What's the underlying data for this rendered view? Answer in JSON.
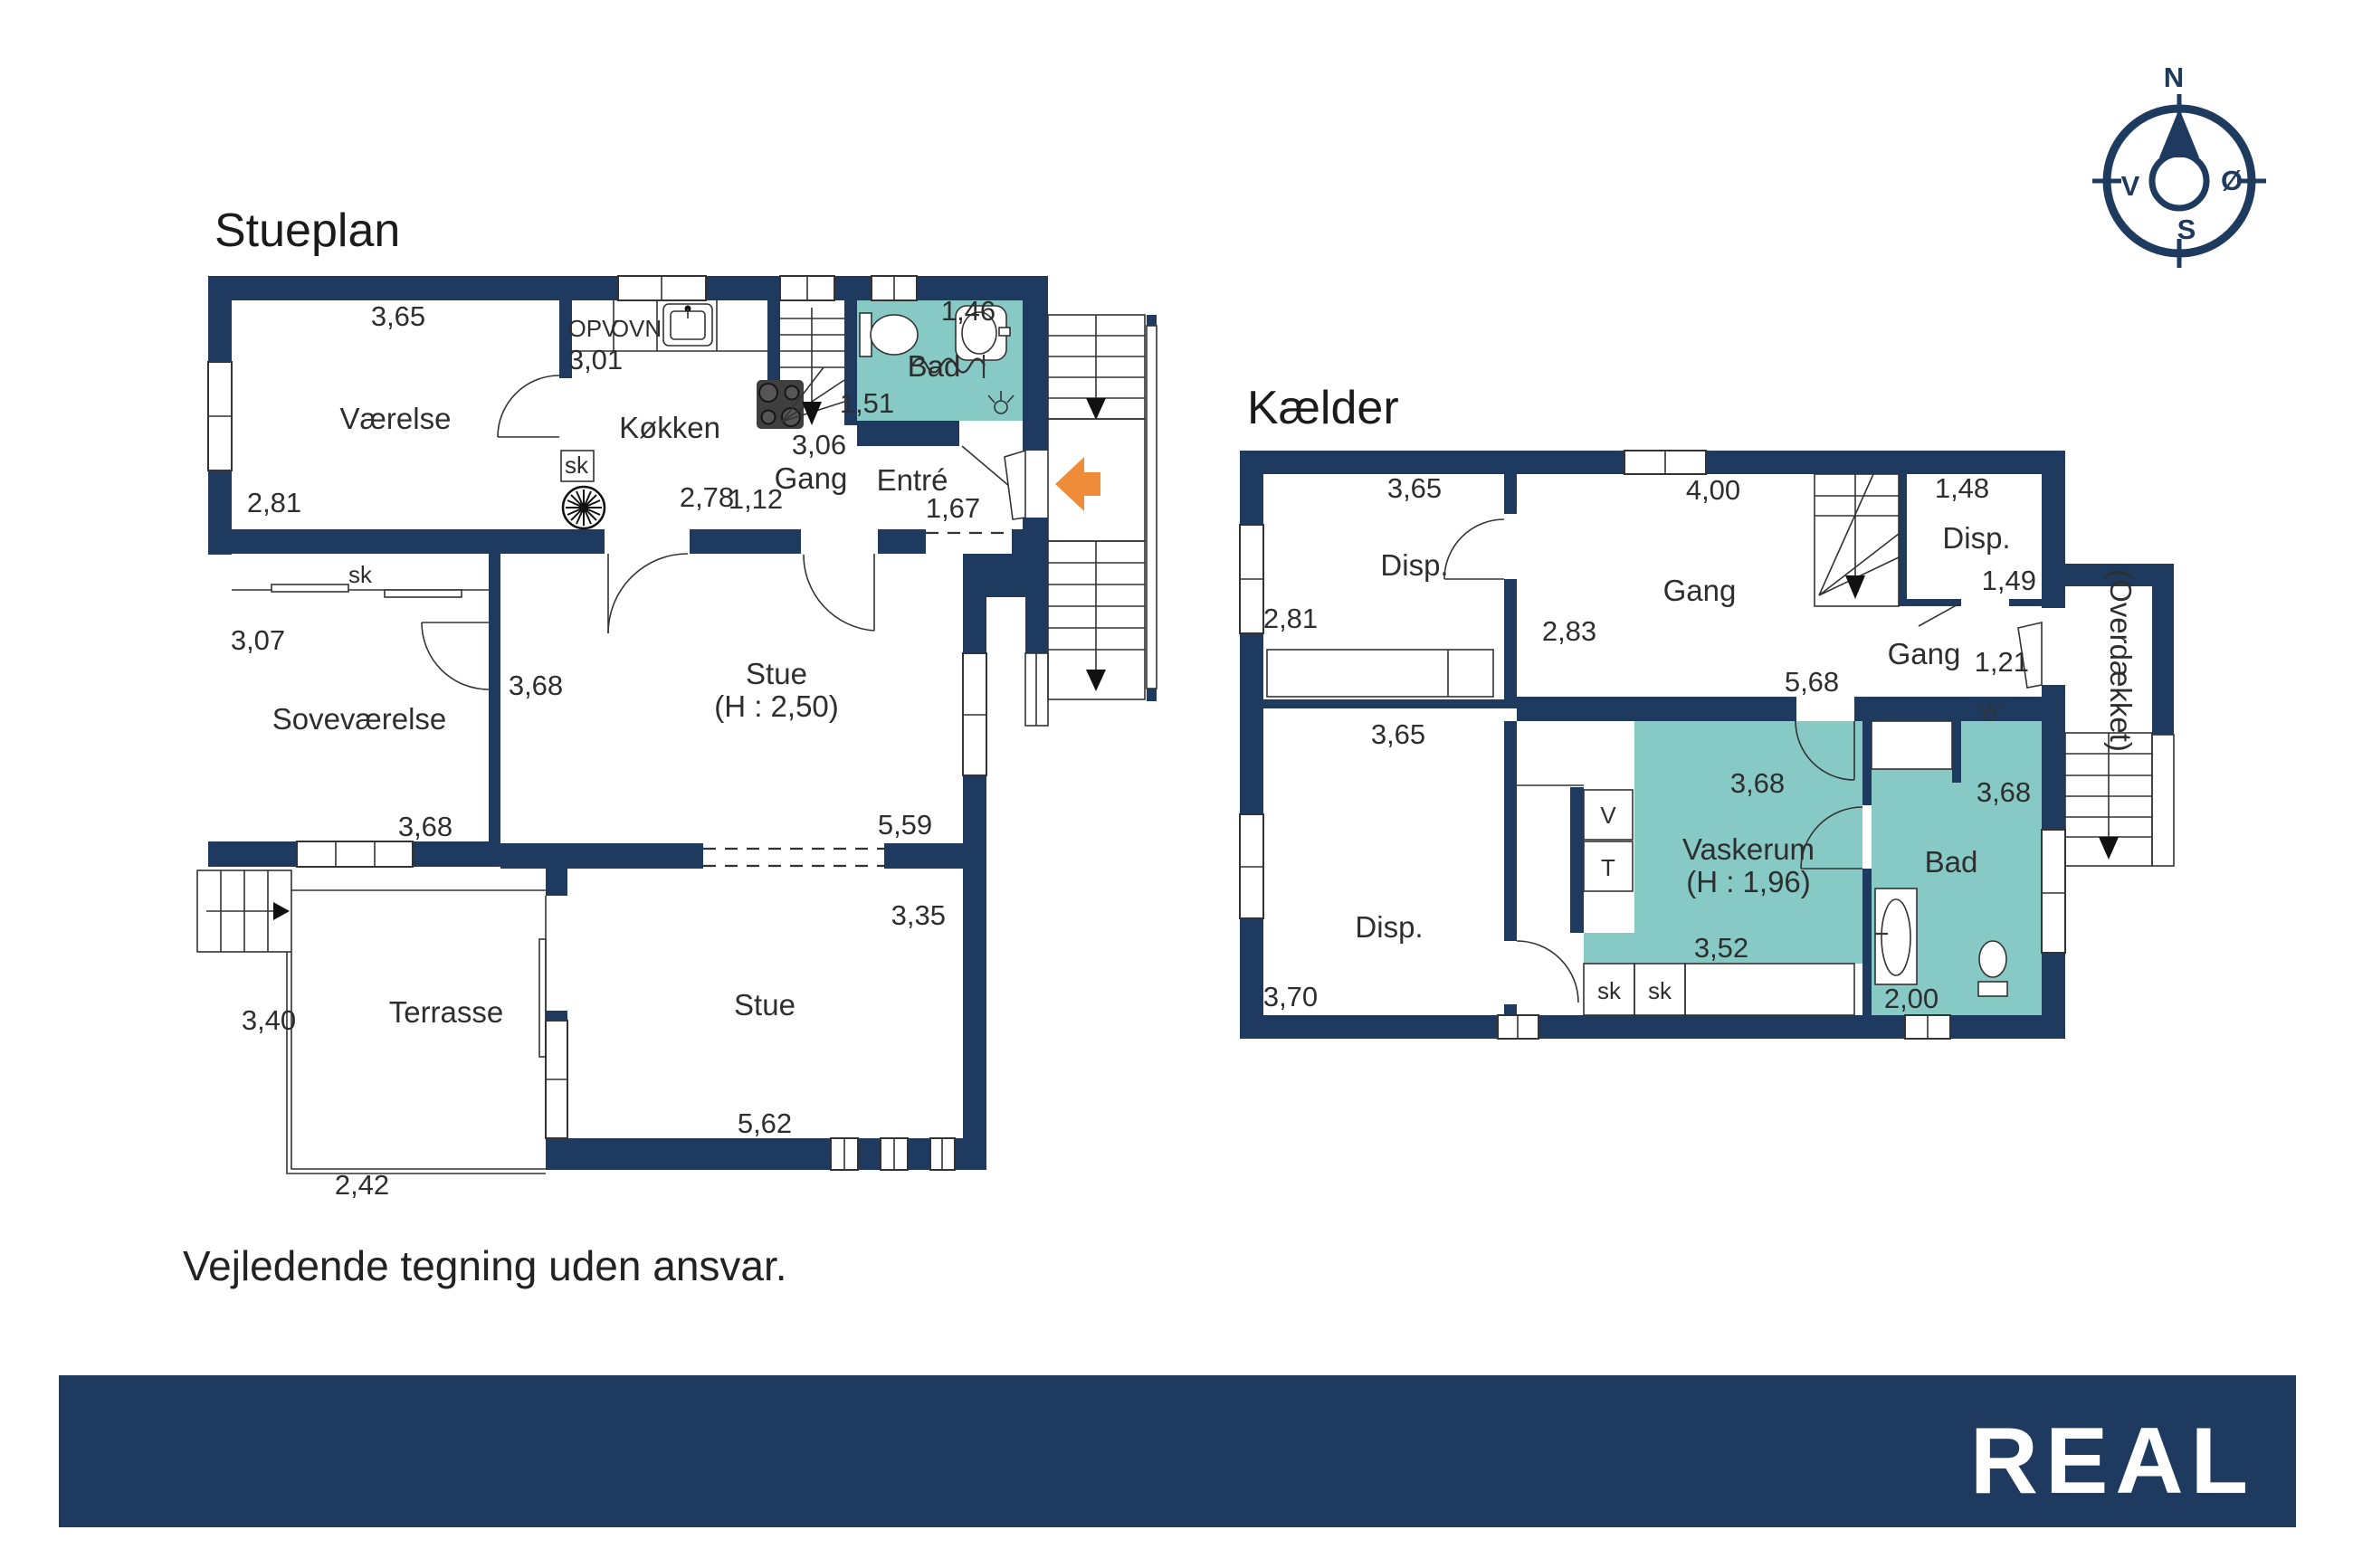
{
  "colors": {
    "wall_navy": "#1E3A5F",
    "room_teal": "#87C9C4",
    "accent_orange": "#EF8C3A"
  },
  "disclaimer": "Vejledende tegning uden ansvar.",
  "logo": {
    "label": "REAL"
  },
  "compass": {
    "north": "N",
    "east": "Ø",
    "south": "S",
    "west": "V"
  },
  "stueplan": {
    "title": "Stueplan",
    "rooms": {
      "vaerelse": "Værelse",
      "koekken": "Køkken",
      "bad": "Bad",
      "gang": "Gang",
      "entre": "Entré",
      "sovevaerelse": "Soveværelse",
      "stue_upper": "Stue",
      "stue_upper_height": "(H : 2,50)",
      "stue_lower": "Stue",
      "terrasse": "Terrasse"
    },
    "fixtures": {
      "opv": "OPV",
      "ovn": "OVN",
      "sk_kitchen": "sk",
      "sk_closet": "sk"
    },
    "dims": {
      "vaerelse_w": "3,65",
      "koekken_w": "3,01",
      "vaerelse_h": "2,81",
      "bad_w": "1,46",
      "bad_h": "1,51",
      "gang_w": "3,06",
      "koekken_d1": "2,78",
      "koekken_d2": "1,12",
      "entre_w": "1,67",
      "sovevaerelse_h": "3,07",
      "sovevaerelse_w": "3,68",
      "stue_upper_w": "3,68",
      "stue_upper_l": "5,59",
      "stue_lower_h": "3,35",
      "stue_lower_w": "5,62",
      "terrasse_h": "3,40",
      "terrasse_w": "2,42"
    }
  },
  "kaelder": {
    "title": "Kælder",
    "rooms": {
      "disp_nw": "Disp.",
      "gang_main": "Gang",
      "disp_ne": "Disp.",
      "gang_east": "Gang",
      "disp_sw": "Disp.",
      "vaskerum": "Vaskerum",
      "vaskerum_height": "(H : 1,96)",
      "bad": "Bad",
      "overdaekket": "(Overdækket)"
    },
    "fixtures": {
      "v": "V",
      "t": "T",
      "sk1": "sk",
      "sk2": "sk"
    },
    "dims": {
      "disp_nw_w": "3,65",
      "gang_w": "4,00",
      "disp_ne_w": "1,48",
      "disp_nw_h": "2,81",
      "gang_h": "2,83",
      "disp_ne_h": "1,49",
      "gang_east_w": "1,21",
      "gang_l": "5,68",
      "disp_sw_w": "3,65",
      "vaskerum_w": "3,68",
      "bad_w": "3,68",
      "disp_sw_h": "3,70",
      "vaskerum_l": "3,52",
      "bad_l": "2,00"
    }
  }
}
